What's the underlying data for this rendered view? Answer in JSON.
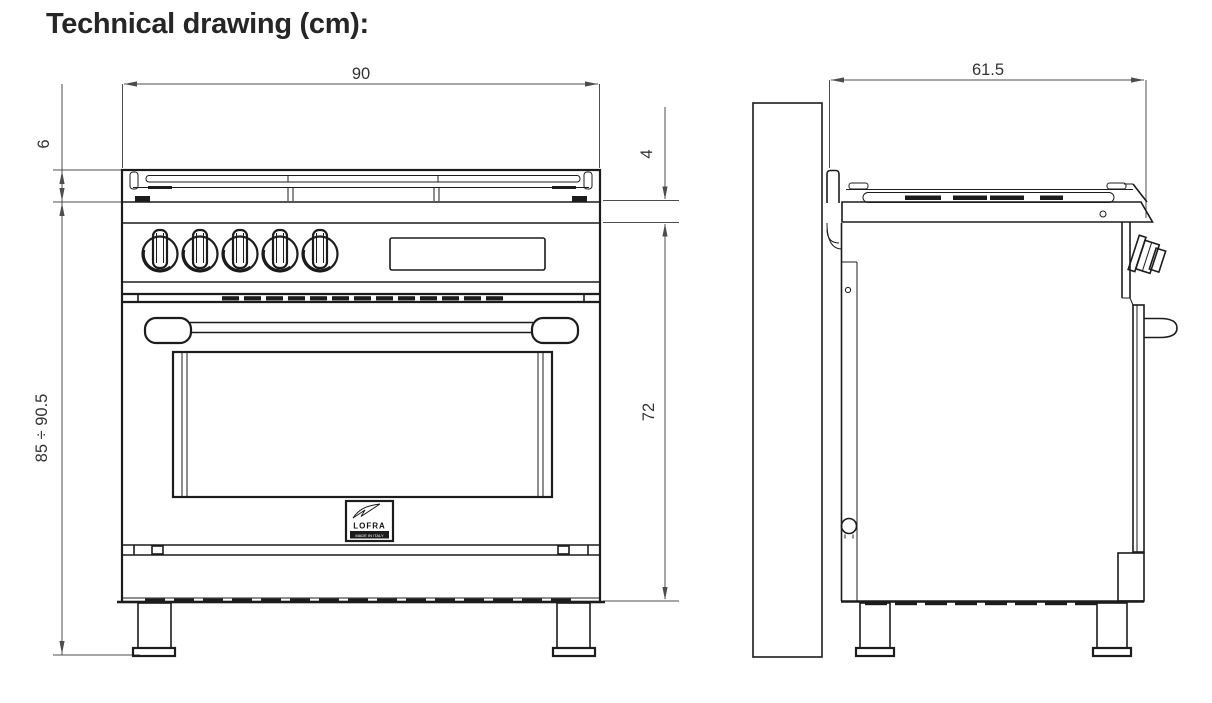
{
  "title": "Technical drawing (cm):",
  "views": {
    "front": {
      "dims": {
        "width": "90",
        "grate_height": "6",
        "overall_height": "85 ÷ 90.5",
        "worktop_band": "4",
        "body_height": "72"
      }
    },
    "side": {
      "dims": {
        "depth": "61.5"
      }
    }
  },
  "logo": {
    "brand": "LOFRA",
    "caption": "MADE IN ITALY"
  },
  "colors": {
    "line": "#1c1c1c",
    "dimension": "#4d4d4d",
    "text": "#333333",
    "title": "#262626",
    "background": "#ffffff"
  }
}
